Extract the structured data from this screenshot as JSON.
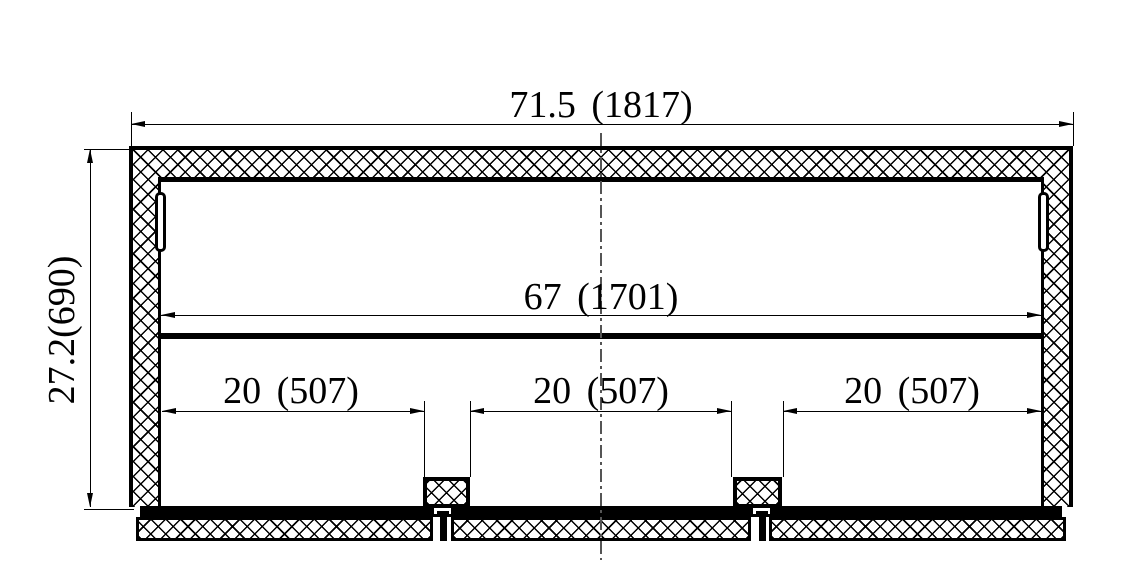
{
  "drawing": {
    "kind": "freezer-cabinet-cross-section",
    "dimension_labels": {
      "overall_width": "71.5 (1817)",
      "overall_height": "27.2(690)",
      "inner_width": "67 (1701)",
      "bay_left": "20 (507)",
      "bay_center": "20 (507)",
      "bay_right": "20 (507)"
    },
    "colors": {
      "line": "#000000",
      "background": "#ffffff",
      "centerline": "#555555"
    }
  }
}
